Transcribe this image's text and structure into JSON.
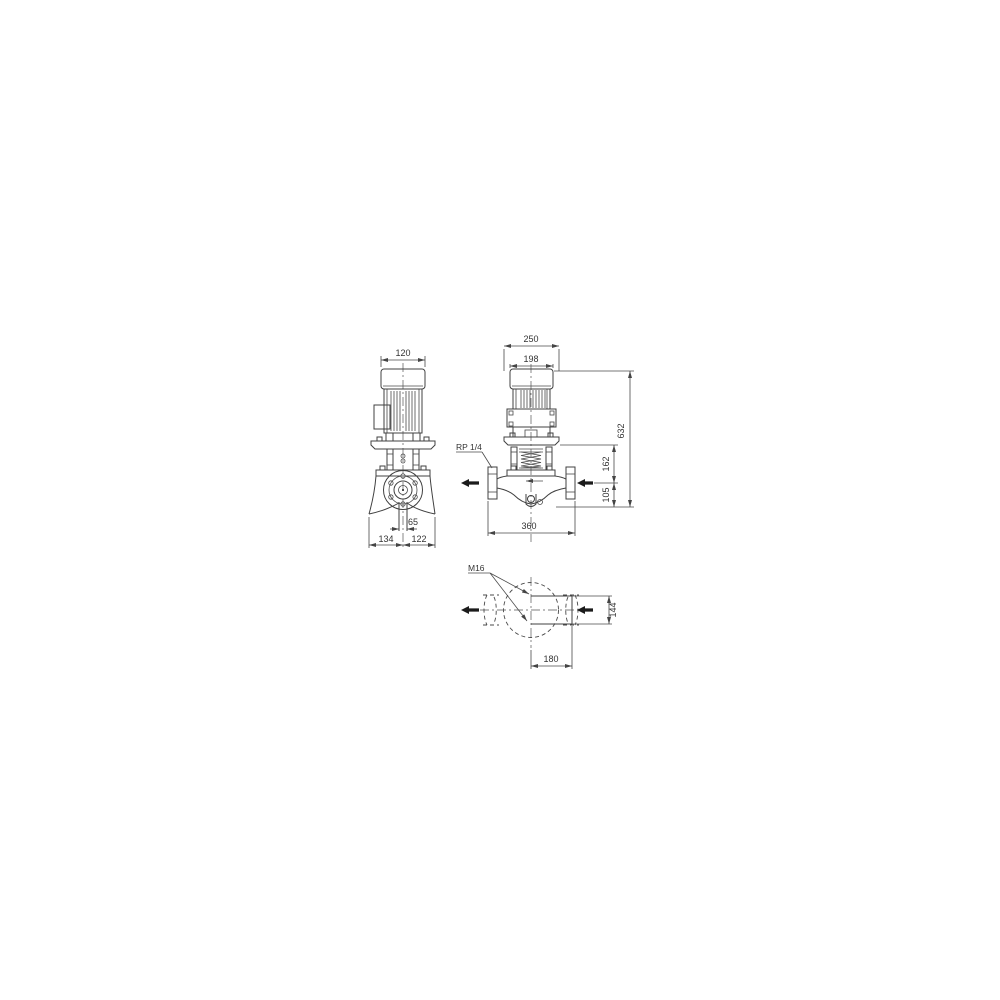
{
  "colors": {
    "line": "#404040",
    "text": "#333333",
    "flow_arrow": "#1b1b1b",
    "background": "#ffffff"
  },
  "side_view": {
    "dim_motor_width": "120",
    "dim_port_stub": "65",
    "dim_base_left": "134",
    "dim_base_right": "122"
  },
  "front_view": {
    "dim_width_outer": "250",
    "dim_width_fan_cover": "198",
    "label_plug": "RP 1/4",
    "dim_height_total": "632",
    "dim_height_mid": "162",
    "dim_height_port": "105",
    "dim_port_to_port": "360"
  },
  "plan_view": {
    "label_bolt": "M16",
    "dim_bolt_spacing": "144",
    "dim_base_length": "180"
  }
}
